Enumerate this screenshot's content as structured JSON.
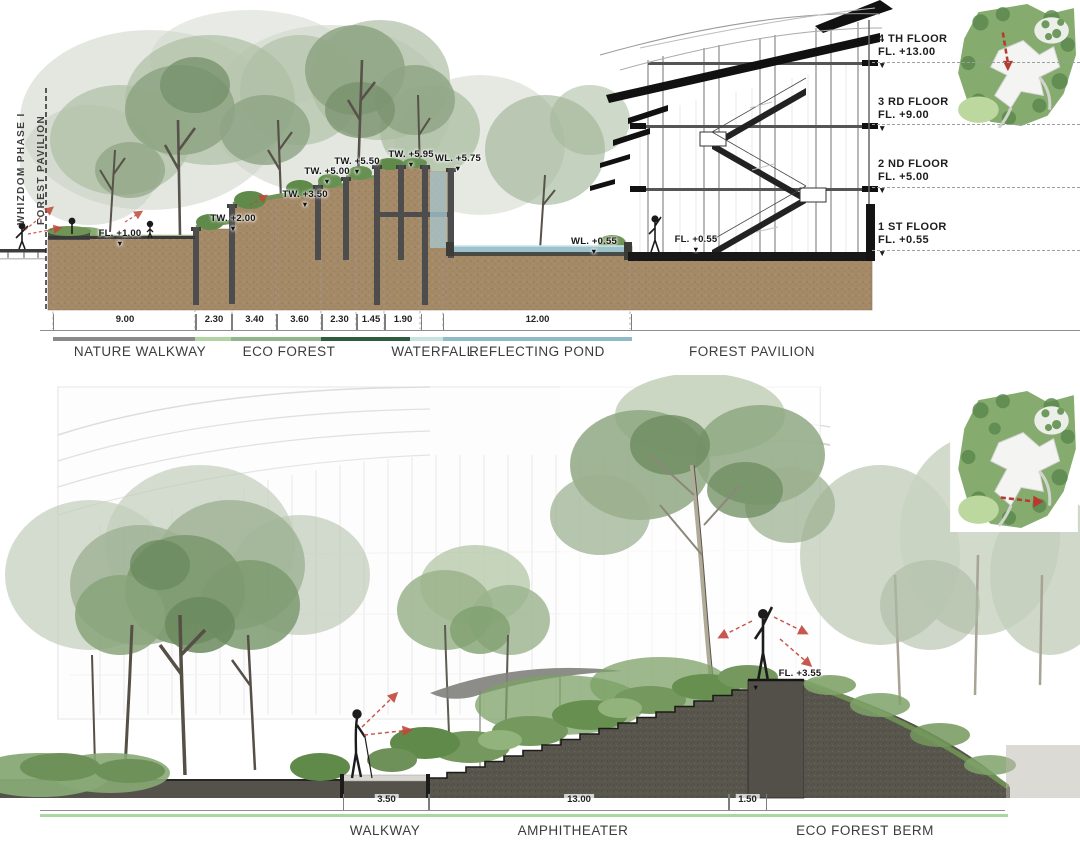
{
  "sheet": {
    "type": "landscape-architecture-sections"
  },
  "colors": {
    "earth": "#a58a68",
    "wall_dark": "#4a4a4a",
    "water": "#9cc2cd",
    "accent_red": "#c2473a",
    "bar_gray": "#8a8a8a",
    "bar_light_green": "#b2d4a2",
    "bar_green": "#90b68b",
    "bar_dark_green": "#2e5c3f",
    "bar_pale_cyan": "#c6e3df",
    "bar_blue": "#8fbac8",
    "walkway_green_line": "#a9d6a2"
  },
  "section_a": {
    "boundary_labels": [
      "WHIZDOM PHASE I",
      "FOREST PAVILION"
    ],
    "level_labels": [
      "FL. +1.00",
      "TW. +2.00",
      "TW. +3.50",
      "TW. +5.00",
      "TW. +5.50",
      "TW. +5.95",
      "WL. +5.75",
      "WL. +0.55",
      "FL. +0.55"
    ],
    "floors": [
      {
        "name": "4 TH FLOOR",
        "level": "FL. +13.00"
      },
      {
        "name": "3 RD FLOOR",
        "level": "FL. +9.00"
      },
      {
        "name": "2 ND FLOOR",
        "level": "FL. +5.00"
      },
      {
        "name": "1 ST FLOOR",
        "level": "FL. +0.55"
      }
    ],
    "dimensions": [
      "9.00",
      "2.30",
      "3.40",
      "3.60",
      "2.30",
      "1.45",
      "1.90",
      "12.00"
    ],
    "zones": [
      "NATURE WALKWAY",
      "ECO FOREST",
      "WATERFALL",
      "REFLECTING POND",
      "FOREST PAVILION"
    ]
  },
  "section_b": {
    "level_label": "FL. +3.55",
    "dimensions": [
      "3.50",
      "13.00",
      "1.50"
    ],
    "zones": [
      "WALKWAY",
      "AMPHITHEATER",
      "ECO FOREST BERM"
    ]
  }
}
